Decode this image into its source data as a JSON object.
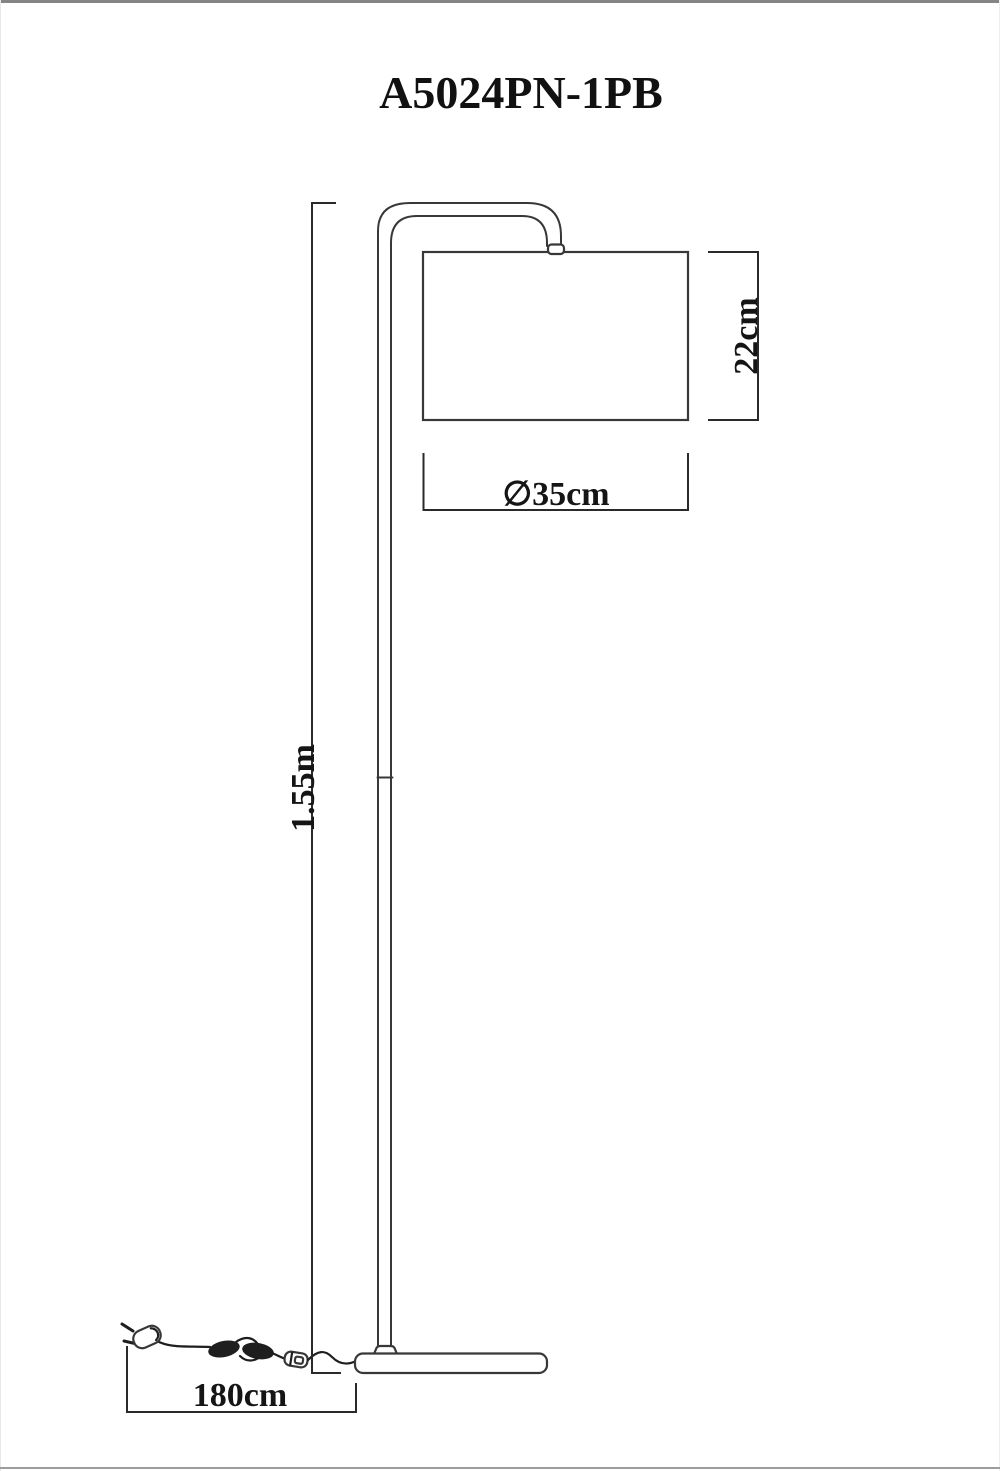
{
  "title": "A5024PN-1PB",
  "dimensions": {
    "shade_height": "22cm",
    "shade_diameter": "∅35cm",
    "lamp_height": "1.55m",
    "cord_length": "180cm"
  },
  "colors": {
    "background": "#ffffff",
    "line": "#383838",
    "dimension_line": "#2a2a2a",
    "text": "#111111",
    "page_border": "#848484"
  }
}
